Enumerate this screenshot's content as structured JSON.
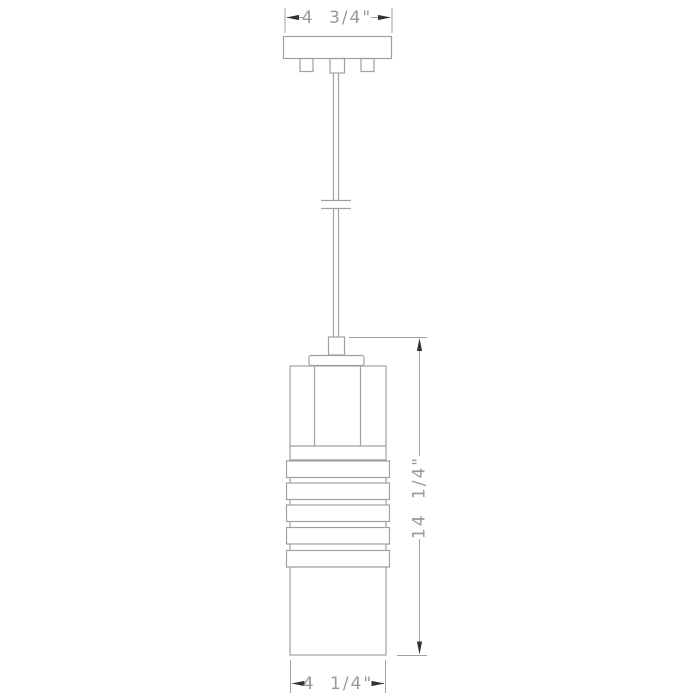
{
  "diagram": {
    "type": "pendant-light-dimension-drawing",
    "band_count": 5,
    "dimensions": {
      "canopy_width": {
        "label": "4 3/4\""
      },
      "fixture_height": {
        "label": "14 1/4\""
      },
      "shade_width": {
        "label": "4 1/4\""
      }
    },
    "colors": {
      "background": "#ffffff",
      "line": "#a0a0a0",
      "line_dark": "#8c8c8c",
      "arrow": "#333333",
      "text": "#999999"
    }
  }
}
